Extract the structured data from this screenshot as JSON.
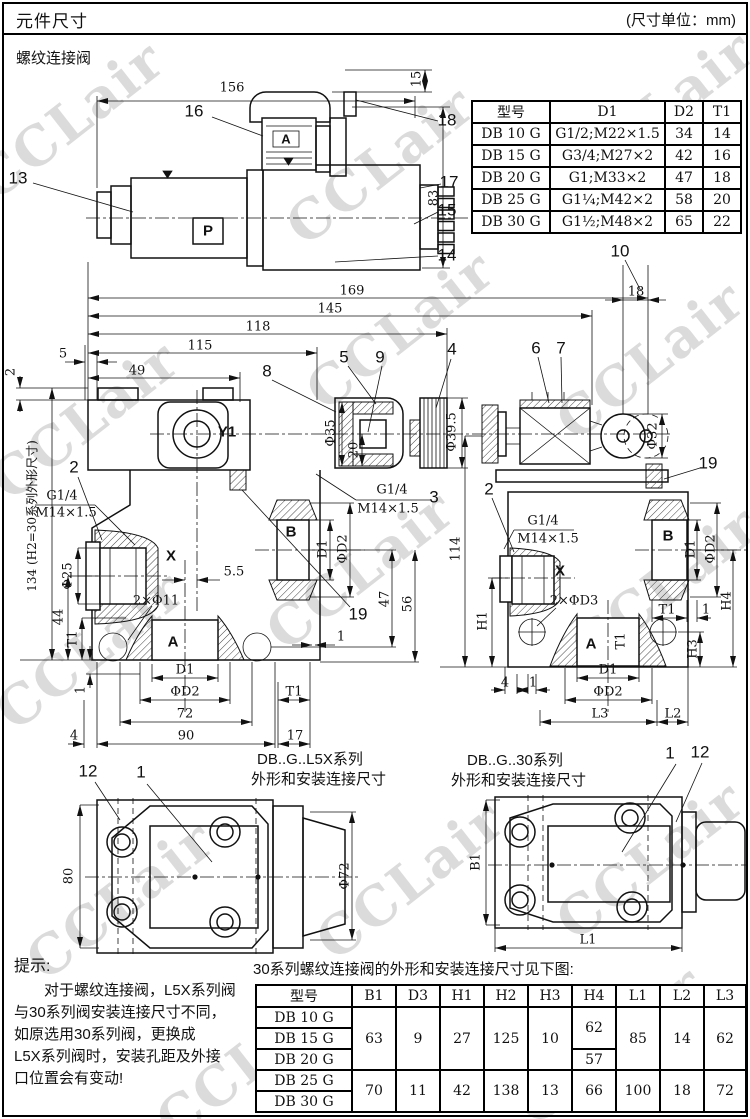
{
  "header": {
    "title": "元件尺寸",
    "unit": "(尺寸单位：mm)"
  },
  "section_label": "螺纹连接阀",
  "watermark": "CCLair",
  "t1": {
    "headers": [
      "型号",
      "D1",
      "D2",
      "T1"
    ],
    "rows": [
      [
        "DB 10 G",
        "G1/2;M22×1.5",
        "34",
        "14"
      ],
      [
        "DB 15 G",
        "G3/4;M27×2",
        "42",
        "16"
      ],
      [
        "DB 20 G",
        "G1;M33×2",
        "47",
        "18"
      ],
      [
        "DB 25 G",
        "G1¼;M42×2",
        "58",
        "20"
      ],
      [
        "DB 30 G",
        "G1½;M48×2",
        "65",
        "22"
      ]
    ]
  },
  "t2": {
    "title": "30系列螺纹连接阀的外形和安装连接尺寸见下图:",
    "headers": [
      "型号",
      "B1",
      "D3",
      "H1",
      "H2",
      "H3",
      "H4",
      "L1",
      "L2",
      "L3"
    ],
    "models": [
      "DB 10 G",
      "DB 15 G",
      "DB 20 G",
      "DB 25 G",
      "DB 30 G"
    ],
    "g1": {
      "b1": "63",
      "d3": "9",
      "h1": "27",
      "h2": "125",
      "h3": "10",
      "h4a": "62",
      "h4b": "57",
      "l1": "85",
      "l2": "14",
      "l3": "62"
    },
    "g2": {
      "b1": "70",
      "d3": "11",
      "h1": "42",
      "h2": "138",
      "h3": "13",
      "h4": "66",
      "l1": "100",
      "l2": "18",
      "l3": "72"
    }
  },
  "note": {
    "title": "提示:",
    "lines": [
      "对于螺纹连接阀，L5X系列阀",
      "与30系列阀安装连接尺寸不同，",
      "如原选用30系列阀，更换成",
      "L5X系列阀时，安装孔距及外接",
      "口位置会有变动!"
    ]
  },
  "lb": {
    "a156": "156",
    "a15": "15",
    "a83": "83",
    "c13": "13",
    "c14": "14",
    "c15": "15",
    "c16": "16",
    "c17": "17",
    "c18": "18",
    "aA": "A",
    "aP": "P",
    "m169": "169",
    "m145": "145",
    "m118": "118",
    "m115": "115",
    "m49": "49",
    "m5": "5",
    "m2": "2",
    "c8": "8",
    "c5b": "5",
    "c9": "9",
    "c4": "4",
    "c10": "10",
    "m18": "18",
    "c6": "6",
    "c7": "7",
    "mY1": "Y1",
    "mPhi35": "Φ35",
    "m20": "20",
    "mPhi395": "Φ39.5",
    "mPhi32": "Φ32",
    "c19a": "19",
    "c19b": "19",
    "c2a": "2",
    "c3": "3",
    "mG14a": "G1/4",
    "mM14a": "M14×1.5",
    "mG14b": "G1/4",
    "mM14b": "M14×1.5",
    "mX": "X",
    "mPhi25": "Φ25",
    "m134": "134 (H2=30系列外形尺寸)",
    "m44": "44",
    "mT1a": "T1",
    "m1a": "1",
    "m55": "5.5",
    "mHoles": "2×Φ11",
    "mA": "A",
    "mB": "B",
    "mD1A": "D1",
    "mD2A": "ΦD2",
    "m72": "72",
    "m90": "90",
    "m17": "17",
    "m4": "4",
    "mT1b": "T1",
    "mD1B": "D1",
    "mD2B": "ΦD2",
    "m47": "47",
    "m56": "56",
    "m114": "114",
    "m1b": "1",
    "r2": "2",
    "rG14": "G1/4",
    "rM14": "M14×1.5",
    "rX": "X",
    "rD3": "2×ΦD3",
    "rA": "A",
    "rT1in": "T1",
    "rD1A": "D1",
    "rD2A": "ΦD2",
    "rL3": "L3",
    "rL2": "L2",
    "r4": "4",
    "r1a": "1",
    "rB": "B",
    "rD1B": "D1",
    "rD2B": "ΦD2",
    "rT1b": "T1",
    "r1b": "1",
    "rH4": "H4",
    "rH3": "H3",
    "rH1": "H1",
    "bl12": "12",
    "bl1": "1",
    "bl80": "80",
    "blPhi72": "Φ72",
    "br1": "1",
    "br12": "12",
    "brB1": "B1",
    "brL1": "L1",
    "capL1": "DB..G..L5X系列",
    "capL2": "外形和安装连接尺寸",
    "capR1": "DB..G..30系列",
    "capR2": "外形和安装连接尺寸"
  }
}
